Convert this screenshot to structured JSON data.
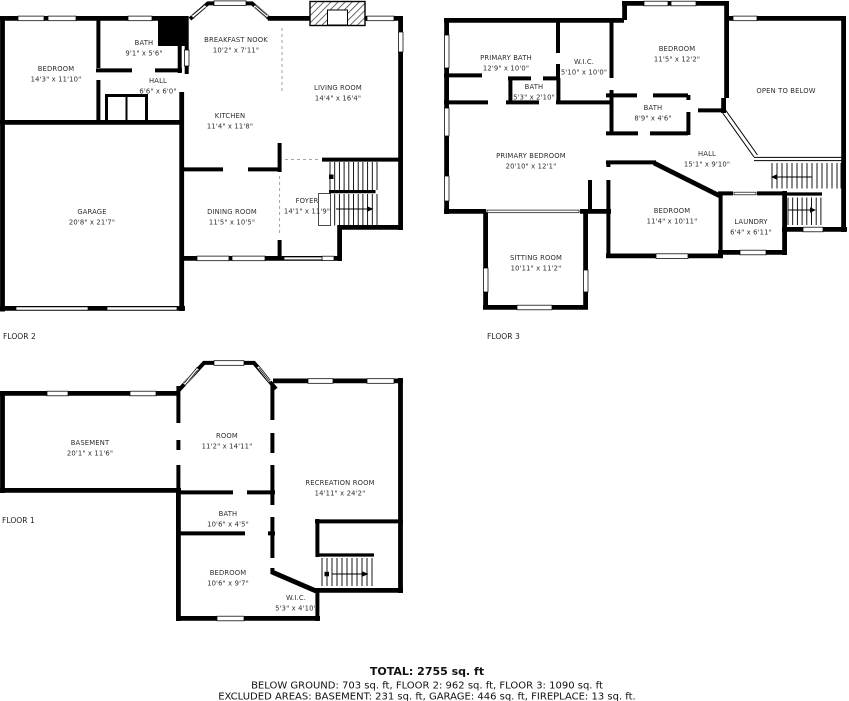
{
  "colors": {
    "wall": "#000000",
    "background": "#ffffff",
    "label_text": "#2d2d2d"
  },
  "floors": [
    {
      "id": "floor2",
      "label": "FLOOR 2",
      "rooms": [
        {
          "name": "BEDROOM",
          "dims": "14'3\" x 11'10\""
        },
        {
          "name": "BATH",
          "dims": "9'1\" x 5'6\""
        },
        {
          "name": "HALL",
          "dims": "6'6\" x 6'0\""
        },
        {
          "name": "BREAKFAST NOOK",
          "dims": "10'2\" x 7'11\""
        },
        {
          "name": "KITCHEN",
          "dims": "11'4\" x 11'8\""
        },
        {
          "name": "LIVING ROOM",
          "dims": "14'4\" x 16'4\""
        },
        {
          "name": "GARAGE",
          "dims": "20'8\" x 21'7\""
        },
        {
          "name": "DINING ROOM",
          "dims": "11'5\" x 10'5\""
        },
        {
          "name": "FOYER",
          "dims": "14'1\" x 11'9\""
        }
      ]
    },
    {
      "id": "floor3",
      "label": "FLOOR 3",
      "rooms": [
        {
          "name": "PRIMARY BATH",
          "dims": "12'9\" x 10'0\""
        },
        {
          "name": "W.I.C.",
          "dims": "5'10\" x 10'0\""
        },
        {
          "name": "BATH",
          "dims": "5'3\" x 2'10\""
        },
        {
          "name": "BEDROOM",
          "dims": "11'5\" x 12'2\""
        },
        {
          "name": "OPEN TO BELOW",
          "dims": ""
        },
        {
          "name": "BATH",
          "dims": "8'9\" x 4'6\""
        },
        {
          "name": "PRIMARY BEDROOM",
          "dims": "20'10\" x 12'1\""
        },
        {
          "name": "HALL",
          "dims": "15'1\" x 9'10\""
        },
        {
          "name": "BEDROOM",
          "dims": "11'4\" x 10'11\""
        },
        {
          "name": "LAUNDRY",
          "dims": "6'4\" x 6'11\""
        },
        {
          "name": "SITTING ROOM",
          "dims": "10'11\" x 11'2\""
        }
      ]
    },
    {
      "id": "floor1",
      "label": "FLOOR 1",
      "rooms": [
        {
          "name": "BASEMENT",
          "dims": "20'1\" x 11'6\""
        },
        {
          "name": "ROOM",
          "dims": "11'2\" x 14'11\""
        },
        {
          "name": "RECREATION ROOM",
          "dims": "14'11\" x 24'2\""
        },
        {
          "name": "BATH",
          "dims": "10'6\" x 4'5\""
        },
        {
          "name": "BEDROOM",
          "dims": "10'6\" x 9'7\""
        },
        {
          "name": "W.I.C.",
          "dims": "5'3\" x 4'10\""
        }
      ]
    }
  ],
  "summary": {
    "total": "TOTAL: 2755 sq. ft",
    "by_floor": "BELOW GROUND: 703 sq. ft, FLOOR 2: 962 sq. ft, FLOOR 3: 1090 sq. ft",
    "excluded": "EXCLUDED AREAS: BASEMENT: 231 sq. ft, GARAGE: 446 sq. ft, FIREPLACE: 13 sq. ft."
  }
}
